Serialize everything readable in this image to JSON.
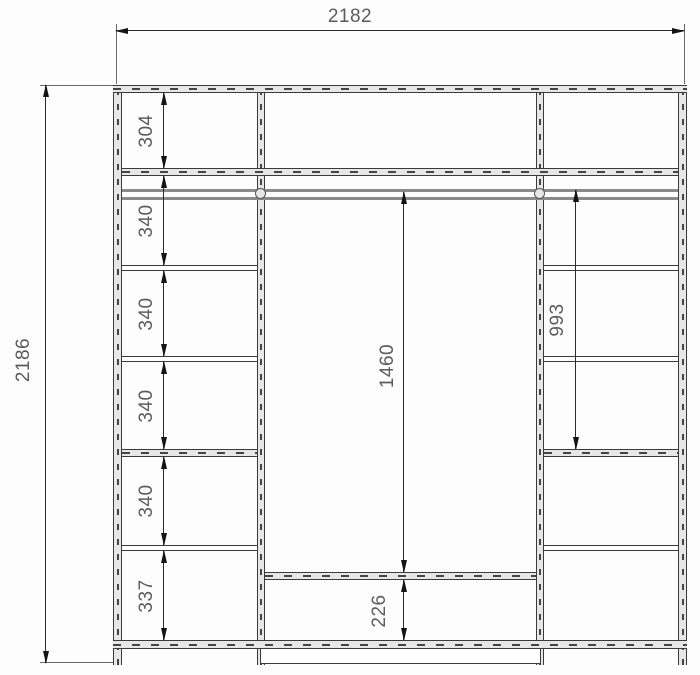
{
  "drawing": {
    "overall": {
      "width_mm": "2182",
      "height_mm": "2186"
    },
    "left_column_sections_mm": [
      "304",
      "340",
      "340",
      "340",
      "340",
      "337"
    ],
    "center": {
      "opening_height_mm": "1460",
      "base_height_mm": "226"
    },
    "right_column": {
      "upper_height_mm": "993"
    }
  },
  "colors": {
    "line": "#3b3b3b",
    "dim_text": "#5c5c5c",
    "panel_fill": "#e7e7e7",
    "background": "#fdfdfd"
  }
}
